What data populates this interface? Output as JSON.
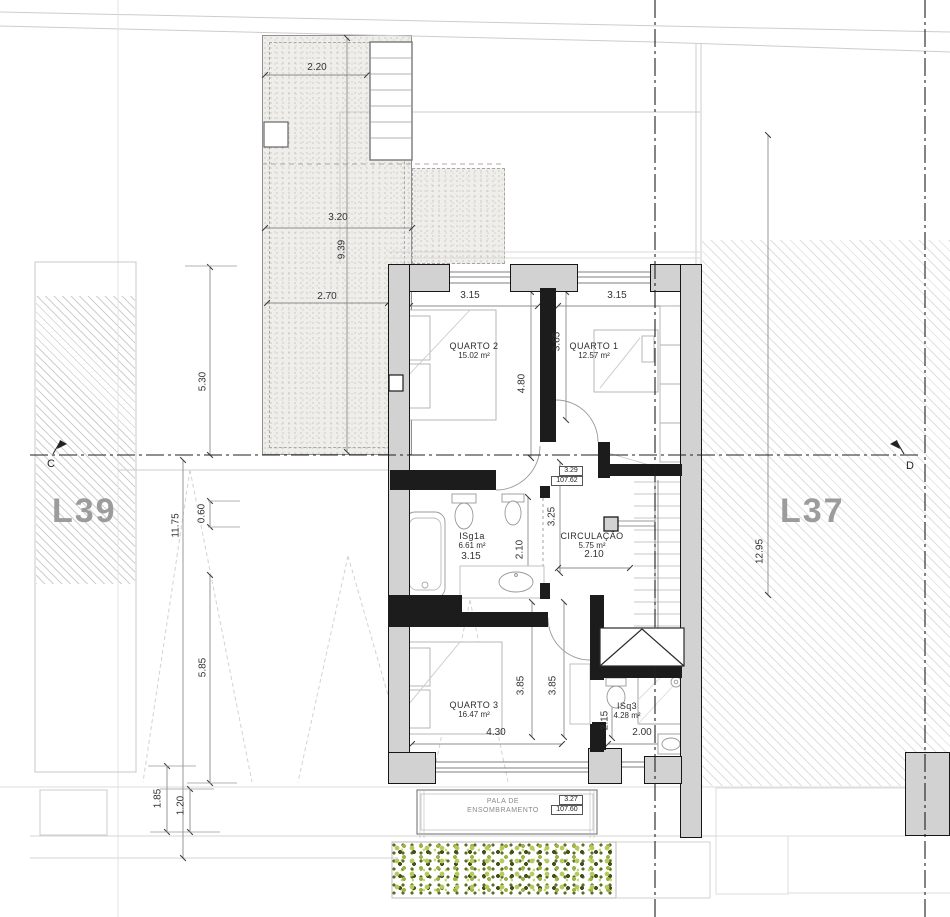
{
  "plan": {
    "lots": {
      "left": "L39",
      "right": "L37"
    },
    "section_markers": {
      "left": "C",
      "right": "D"
    },
    "rooms": {
      "quarto2": {
        "name": "QUARTO 2",
        "area": "15.02 m²"
      },
      "quarto1": {
        "name": "QUARTO 1",
        "area": "12.57 m²"
      },
      "isg1a": {
        "name": "ISg1a",
        "area": "6.61 m²"
      },
      "circulacao": {
        "name": "CIRCULAÇÃO",
        "area": "5.75 m²"
      },
      "quarto3": {
        "name": "QUARTO 3",
        "area": "16.47 m²"
      },
      "isq3": {
        "name": "ISq3",
        "area": "4.28 m²"
      }
    },
    "levels": {
      "upper": {
        "value": "3.29",
        "elevation": "107.62"
      },
      "lower": {
        "value": "3.27",
        "elevation": "107.60"
      }
    },
    "pala": {
      "line1": "PALA DE",
      "line2": "ENSOMBRAMENTO"
    },
    "dims": {
      "terrace_width": "2.20",
      "terrace_mid": "3.20",
      "terrace_length": "9.39",
      "terrace_bottom": "2.70",
      "garden_530": "5.30",
      "garden_1175": "11.75",
      "garden_060": "0.60",
      "garden_585": "5.85",
      "garden_185": "1.85",
      "garden_120": "1.20",
      "q2_width": "3.15",
      "q1_width": "3.15",
      "q2_depth": "4.80",
      "q1_depth": "3.65",
      "hall_depth": "3.25",
      "bath_width": "3.15",
      "bath_depth": "2.10",
      "hall_width": "2.10",
      "q3_depth_a": "3.85",
      "q3_depth_b": "3.85",
      "q3_width": "4.30",
      "isq3_depth": "2.15",
      "isq3_width": "2.00",
      "lot_right_depth": "12.95"
    },
    "colors": {
      "wall_fill": "#d2d2d2",
      "hedge_light": "#b6ca5b",
      "hedge_dark": "#44511d"
    }
  }
}
